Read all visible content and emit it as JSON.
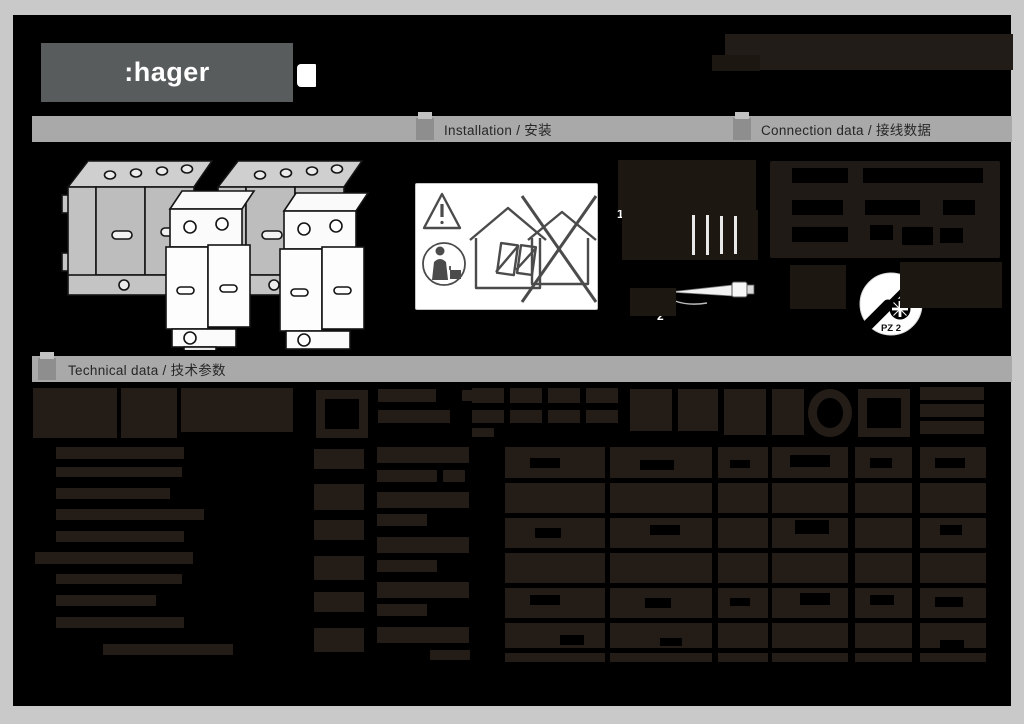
{
  "header": {
    "logo_text": ":hager"
  },
  "sections": {
    "installation_label": "Installation / 安装",
    "connection_label": "Connection data / 接线数据",
    "technical_label": "Technical data / 技术参数"
  },
  "connection": {
    "step1_label": "1",
    "step2_label": "2",
    "screwdriver_type": "PZ 2",
    "torque_value": "2.5Nm"
  },
  "colors": {
    "page_margin": "#c9c9c9",
    "content_bg": "#000000",
    "bar_gray": "#a9a9a9",
    "bar_marker_gray": "#8e8e8e",
    "bar_text": "#262626",
    "logo_bg": "#595c5c",
    "ink_dark": "#231c17",
    "white": "#ffffff"
  },
  "conn_panel": {
    "box": [
      770,
      161,
      230,
      97
    ],
    "holes": [
      [
        792,
        168,
        56,
        15
      ],
      [
        863,
        168,
        120,
        15
      ],
      [
        792,
        200,
        51,
        15
      ],
      [
        865,
        200,
        55,
        15
      ],
      [
        943,
        200,
        32,
        15
      ],
      [
        792,
        227,
        56,
        15
      ],
      [
        870,
        225,
        23,
        15
      ],
      [
        902,
        227,
        31,
        18
      ],
      [
        940,
        228,
        23,
        15
      ]
    ]
  },
  "wire_area": {
    "ink_blocks": [
      [
        618,
        160,
        138,
        50
      ],
      [
        622,
        210,
        136,
        50
      ],
      [
        630,
        288,
        46,
        28
      ],
      [
        900,
        262,
        102,
        46
      ],
      [
        790,
        265,
        56,
        44
      ],
      [
        712,
        55,
        48,
        16
      ]
    ],
    "slivers": [
      [
        692,
        215,
        3,
        40
      ],
      [
        706,
        215,
        3,
        40
      ],
      [
        720,
        216,
        3,
        38
      ],
      [
        734,
        216,
        3,
        38
      ]
    ]
  },
  "table": {
    "header_blocks": [
      [
        33,
        388,
        84,
        50
      ],
      [
        121,
        388,
        56,
        50
      ],
      [
        181,
        388,
        112,
        44
      ],
      [
        378,
        389,
        58,
        13
      ],
      [
        378,
        410,
        72,
        13
      ],
      [
        462,
        390,
        12,
        11
      ],
      [
        472,
        388,
        32,
        15
      ],
      [
        472,
        410,
        32,
        13
      ],
      [
        472,
        428,
        22,
        9
      ],
      [
        510,
        388,
        32,
        15
      ],
      [
        510,
        410,
        32,
        13
      ],
      [
        548,
        388,
        32,
        15
      ],
      [
        548,
        410,
        32,
        13
      ],
      [
        586,
        388,
        32,
        15
      ],
      [
        586,
        410,
        32,
        13
      ],
      [
        630,
        389,
        42,
        42
      ],
      [
        678,
        389,
        40,
        42
      ],
      [
        724,
        389,
        42,
        46
      ],
      [
        772,
        389,
        32,
        46
      ],
      [
        920,
        387,
        64,
        13
      ],
      [
        920,
        404,
        64,
        13
      ],
      [
        920,
        421,
        64,
        13
      ]
    ],
    "frames": [
      [
        316,
        390,
        52,
        48
      ],
      [
        858,
        389,
        52,
        48
      ]
    ],
    "rings": [
      [
        808,
        389,
        44,
        48
      ]
    ],
    "left_bars": [
      [
        56,
        447,
        128,
        12
      ],
      [
        56,
        467,
        126,
        10
      ],
      [
        56,
        488,
        114,
        11
      ],
      [
        56,
        509,
        148,
        11
      ],
      [
        56,
        531,
        128,
        11
      ],
      [
        35,
        552,
        158,
        12
      ],
      [
        56,
        574,
        126,
        10
      ],
      [
        56,
        595,
        100,
        11
      ],
      [
        56,
        617,
        128,
        11
      ],
      [
        103,
        644,
        130,
        11
      ]
    ],
    "col_blocks": [
      [
        314,
        449,
        50,
        20
      ],
      [
        314,
        484,
        50,
        26
      ],
      [
        314,
        520,
        50,
        20
      ],
      [
        314,
        556,
        50,
        24
      ],
      [
        314,
        592,
        50,
        20
      ],
      [
        314,
        628,
        50,
        24
      ],
      [
        377,
        447,
        92,
        16
      ],
      [
        377,
        470,
        60,
        12
      ],
      [
        443,
        470,
        22,
        12
      ],
      [
        377,
        492,
        92,
        16
      ],
      [
        377,
        514,
        50,
        12
      ],
      [
        377,
        537,
        92,
        16
      ],
      [
        377,
        560,
        60,
        12
      ],
      [
        377,
        582,
        92,
        16
      ],
      [
        377,
        604,
        50,
        12
      ],
      [
        377,
        627,
        92,
        16
      ],
      [
        430,
        650,
        40,
        10
      ]
    ],
    "strips": [
      [
        505,
        447,
        100,
        215
      ],
      [
        610,
        447,
        102,
        215
      ],
      [
        718,
        447,
        50,
        215
      ],
      [
        772,
        447,
        76,
        215
      ],
      [
        855,
        447,
        57,
        215
      ],
      [
        920,
        447,
        66,
        215
      ]
    ],
    "row_lines": [
      [
        500,
        478,
        490,
        5
      ],
      [
        500,
        513,
        490,
        5
      ],
      [
        500,
        548,
        490,
        5
      ],
      [
        500,
        583,
        490,
        5
      ],
      [
        500,
        618,
        490,
        5
      ],
      [
        500,
        648,
        490,
        5
      ]
    ],
    "holes": [
      [
        530,
        458,
        30,
        10
      ],
      [
        640,
        460,
        34,
        10
      ],
      [
        730,
        460,
        20,
        8
      ],
      [
        790,
        455,
        40,
        12
      ],
      [
        870,
        458,
        22,
        10
      ],
      [
        935,
        458,
        30,
        10
      ],
      [
        535,
        528,
        26,
        10
      ],
      [
        650,
        525,
        30,
        10
      ],
      [
        795,
        520,
        34,
        14
      ],
      [
        940,
        525,
        22,
        10
      ],
      [
        530,
        595,
        30,
        10
      ],
      [
        645,
        598,
        26,
        10
      ],
      [
        730,
        598,
        20,
        8
      ],
      [
        800,
        593,
        30,
        12
      ],
      [
        870,
        595,
        24,
        10
      ],
      [
        935,
        597,
        28,
        10
      ],
      [
        560,
        635,
        24,
        10
      ],
      [
        660,
        638,
        22,
        8
      ],
      [
        940,
        640,
        24,
        8
      ]
    ]
  }
}
